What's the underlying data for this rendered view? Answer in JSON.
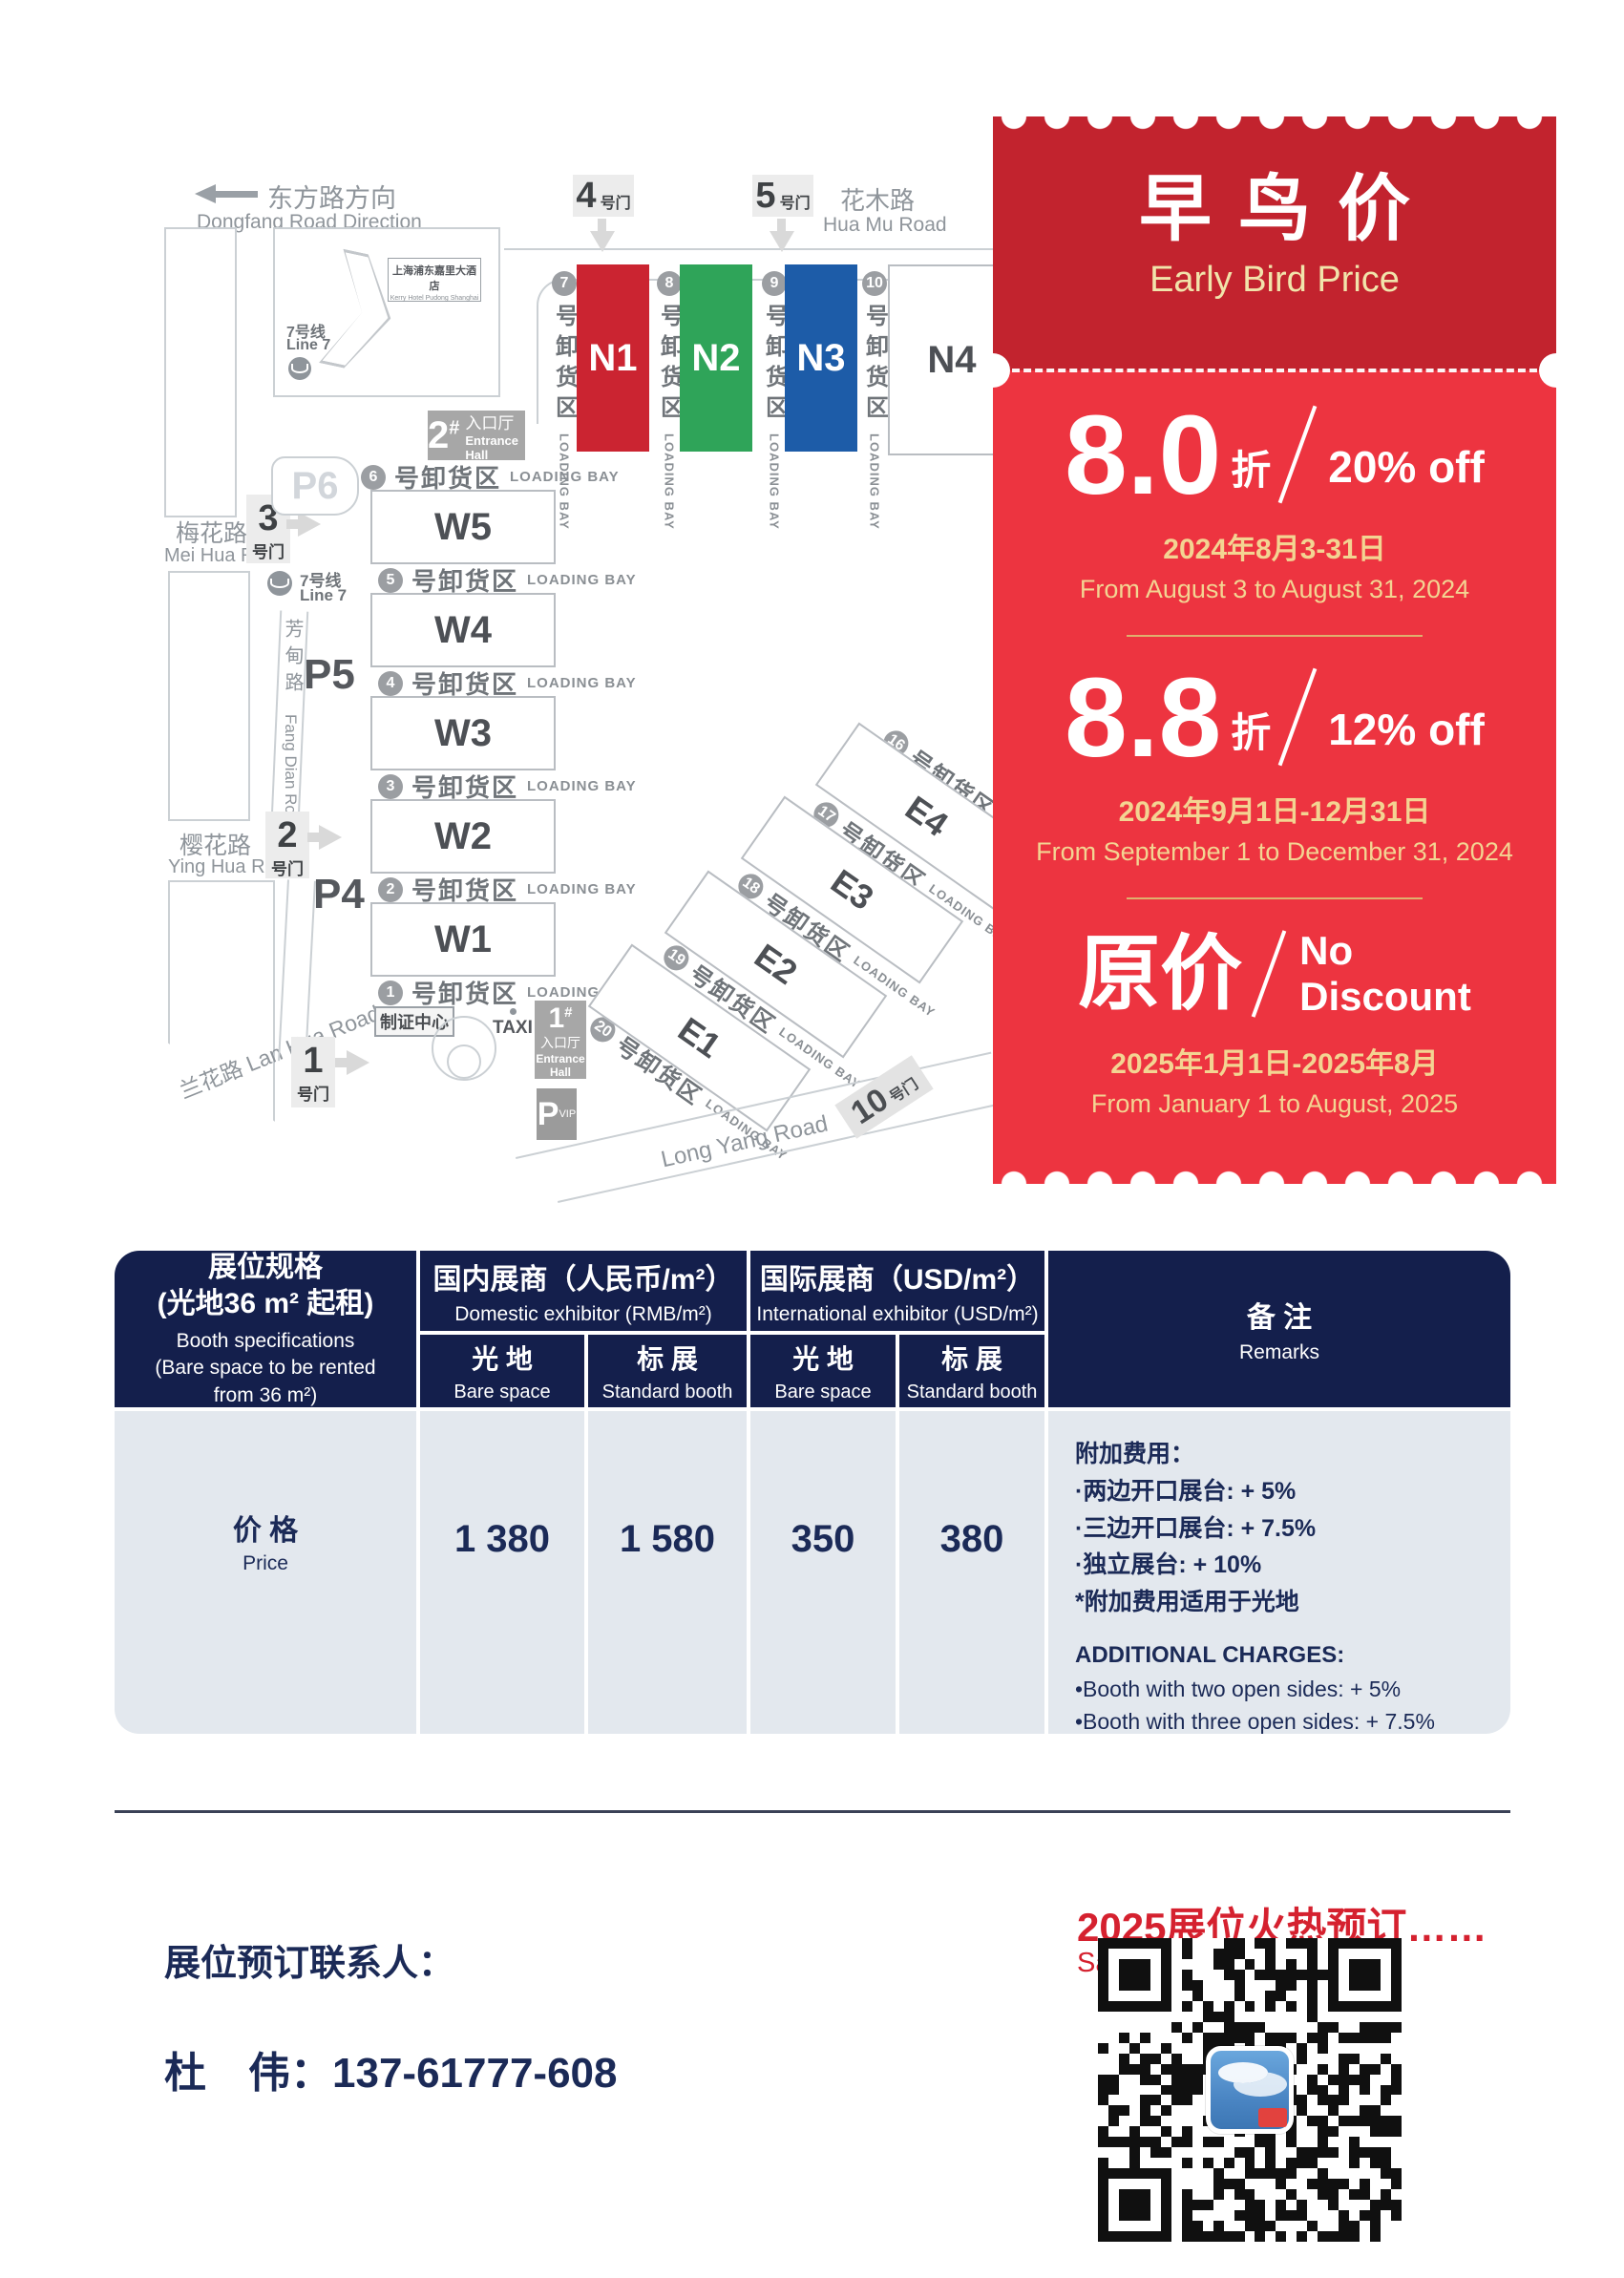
{
  "map": {
    "direction_sign": {
      "zh": "东方路方向",
      "en": "Dongfang Road Direction"
    },
    "roads": {
      "huamu_zh": "花木路",
      "huamu_en": "Hua Mu Road",
      "meihua_zh": "梅花路",
      "meihua_en": "Mei Hua Road",
      "yinghua_zh": "樱花路",
      "yinghua_en": "Ying Hua Road",
      "lanhua": "兰花路 Lan Hua Road",
      "longyang": "Long Yang Road",
      "fangdian_zh": "芳甸路",
      "fangdian_en": "Fang Dian Road"
    },
    "metro": {
      "zh": "7号线",
      "en": "Line 7"
    },
    "hotel": {
      "zh": "上海浦东嘉里大酒店",
      "en": "Kerry Hotel Pudong Shanghai"
    },
    "gates": {
      "g1": "1",
      "g2": "2",
      "g3": "3",
      "g4": "4",
      "g5": "5",
      "g10": "10",
      "suffix": "号门"
    },
    "parking": {
      "p4": "P4",
      "p5": "P5",
      "p6": "P6",
      "vip_letter": "P",
      "vip_sub": "VIP"
    },
    "entrances": {
      "e1_num": "1",
      "e2_num": "2",
      "hash": "#",
      "hall_zh": "入口厅",
      "hall_en": "Entrance Hall",
      "hall_en_1": "Entrance",
      "hall_en_2": "Hall"
    },
    "badge_center": "制证中心",
    "taxi": "TAXI",
    "halls": {
      "n1": "N1",
      "n2": "N2",
      "n3": "N3",
      "n4": "N4",
      "w1": "W1",
      "w2": "W2",
      "w3": "W3",
      "w4": "W4",
      "w5": "W5",
      "e1": "E1",
      "e2": "E2",
      "e3": "E3",
      "e4": "E4"
    },
    "bay": {
      "zh": "号卸货区",
      "en": "LOADING BAY"
    },
    "bay_nums": {
      "w": [
        "6",
        "5",
        "4",
        "3",
        "2",
        "1"
      ],
      "n": [
        "7",
        "8",
        "9",
        "10"
      ],
      "e": [
        "16",
        "17",
        "18",
        "19",
        "20"
      ]
    },
    "hall_colors": {
      "n1": "#cb2431",
      "n2": "#2fa459",
      "n3": "#1d5ca8"
    }
  },
  "ticket": {
    "title_zh": "早鸟价",
    "title_en": "Early Bird Price",
    "colors": {
      "header_red": "#c2232e",
      "body_red": "#ed3440",
      "gold": "#f3d492"
    },
    "tiers": [
      {
        "value": "8.0",
        "unit": "折",
        "offer": "20% off",
        "date_zh": "2024年8月3-31日",
        "date_en": "From August 3 to August 31, 2024"
      },
      {
        "value": "8.8",
        "unit": "折",
        "offer": "12% off",
        "date_zh": "2024年9月1日-12月31日",
        "date_en": "From September 1 to December 31, 2024"
      },
      {
        "value": "原价",
        "offer_line1": "No",
        "offer_line2": "Discount",
        "date_zh": "2025年1月1日-2025年8月",
        "date_en": "From January 1 to August, 2025"
      }
    ]
  },
  "table": {
    "spec": {
      "zh1": "展位规格",
      "zh2": "(光地36 m² 起租)",
      "en1": "Booth specifications",
      "en2": "(Bare space to be rented",
      "en3": "from 36 m²)"
    },
    "domestic": {
      "zh": "国内展商（人民币/m²）",
      "en": "Domestic exhibitor (RMB/m²)"
    },
    "international": {
      "zh": "国际展商（USD/m²）",
      "en": "International exhibitor (USD/m²)"
    },
    "sub": {
      "bare_zh": "光 地",
      "bare_en": "Bare space",
      "std_zh": "标 展",
      "std_en": "Standard booth"
    },
    "remarks_header": {
      "zh": "备 注",
      "en": "Remarks"
    },
    "row": {
      "label_zh": "价 格",
      "label_en": "Price",
      "values": [
        "1 380",
        "1 580",
        "350",
        "380"
      ]
    },
    "remarks": {
      "zh": [
        "附加费用：",
        "·两边开口展台: + 5%",
        "·三边开口展台: + 7.5%",
        "·独立展台: + 10%",
        "*附加费用适用于光地"
      ],
      "en": [
        "ADDITIONAL CHARGES:",
        "•Booth with two open sides: + 5%",
        "•Booth with three open sides: + 7.5%",
        "•Independent booth: + 10%",
        "*Additional charges apply to bare space"
      ]
    }
  },
  "contact": {
    "headline": "2025展位火热预订……",
    "subline": "Sales Hotline",
    "label": "展位预订联系人：",
    "person": "杜　伟：137-61777-608",
    "accent_color": "#d5212f"
  }
}
